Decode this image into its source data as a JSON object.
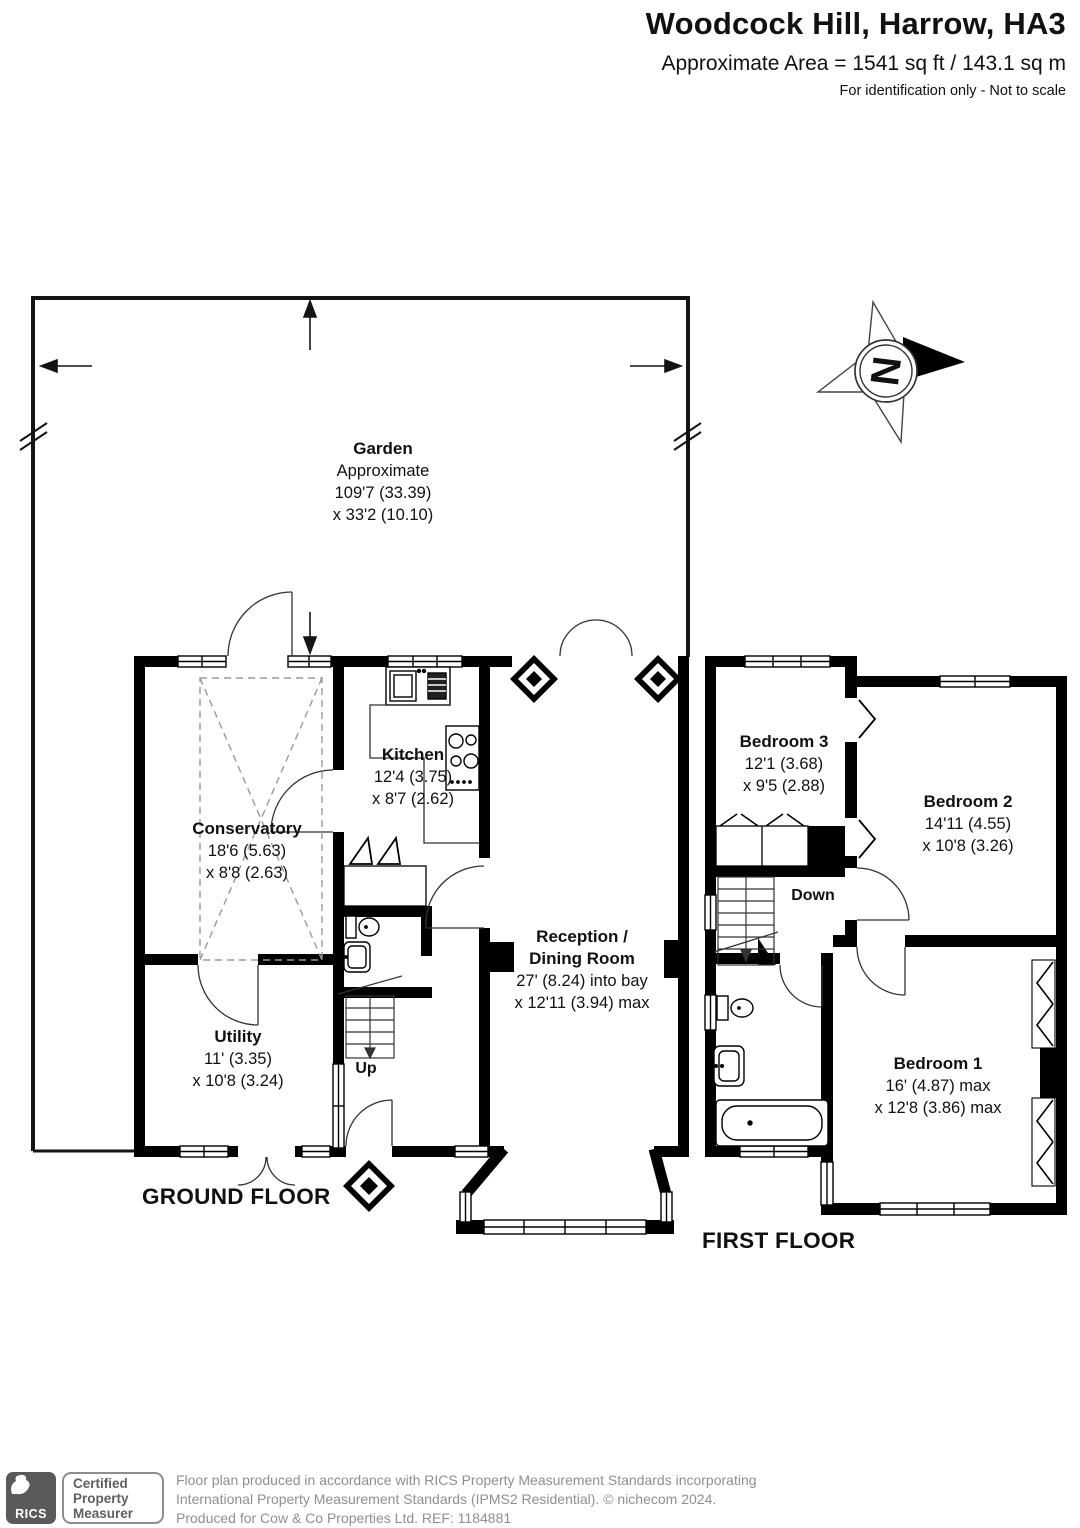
{
  "header": {
    "title": "Woodcock Hill, Harrow, HA3",
    "area_line": "Approximate Area = 1541 sq ft / 143.1 sq m",
    "disclaimer": "For identification only - Not to scale"
  },
  "compass": {
    "north_label": "N"
  },
  "garden": {
    "name": "Garden",
    "sub": "Approximate",
    "dim1": "109'7 (33.39)",
    "dim2": "x 33'2 (10.10)"
  },
  "rooms": {
    "conservatory": {
      "name": "Conservatory",
      "dim1": "18'6 (5.63)",
      "dim2": "x 8'8 (2.63)"
    },
    "kitchen": {
      "name": "Kitchen",
      "dim1": "12'4 (3.75)",
      "dim2": "x 8'7 (2.62)"
    },
    "utility": {
      "name": "Utility",
      "dim1": "11' (3.35)",
      "dim2": "x 10'8 (3.24)"
    },
    "reception": {
      "name_line1": "Reception /",
      "name_line2": "Dining Room",
      "dim1": "27' (8.24) into bay",
      "dim2": "x 12'11 (3.94) max"
    },
    "bedroom3": {
      "name": "Bedroom 3",
      "dim1": "12'1 (3.68)",
      "dim2": "x 9'5 (2.88)"
    },
    "bedroom2": {
      "name": "Bedroom 2",
      "dim1": "14'11 (4.55)",
      "dim2": "x 10'8 (3.26)"
    },
    "bedroom1": {
      "name": "Bedroom 1",
      "dim1": "16' (4.87) max",
      "dim2": "x 12'8 (3.86) max"
    }
  },
  "stairs": {
    "up_label": "Up",
    "down_label": "Down"
  },
  "floors": {
    "ground_label": "GROUND FLOOR",
    "first_label": "FIRST FLOOR"
  },
  "footer": {
    "rics_label": "RICS",
    "badge_line1": "Certified",
    "badge_line2": "Property",
    "badge_line3": "Measurer",
    "line1": "Floor plan produced in accordance with RICS Property Measurement Standards incorporating",
    "line2": "International Property Measurement Standards (IPMS2 Residential).   © nichecom 2024.",
    "line3": "Produced for Cow & Co Properties Ltd.   REF: 1184881"
  }
}
